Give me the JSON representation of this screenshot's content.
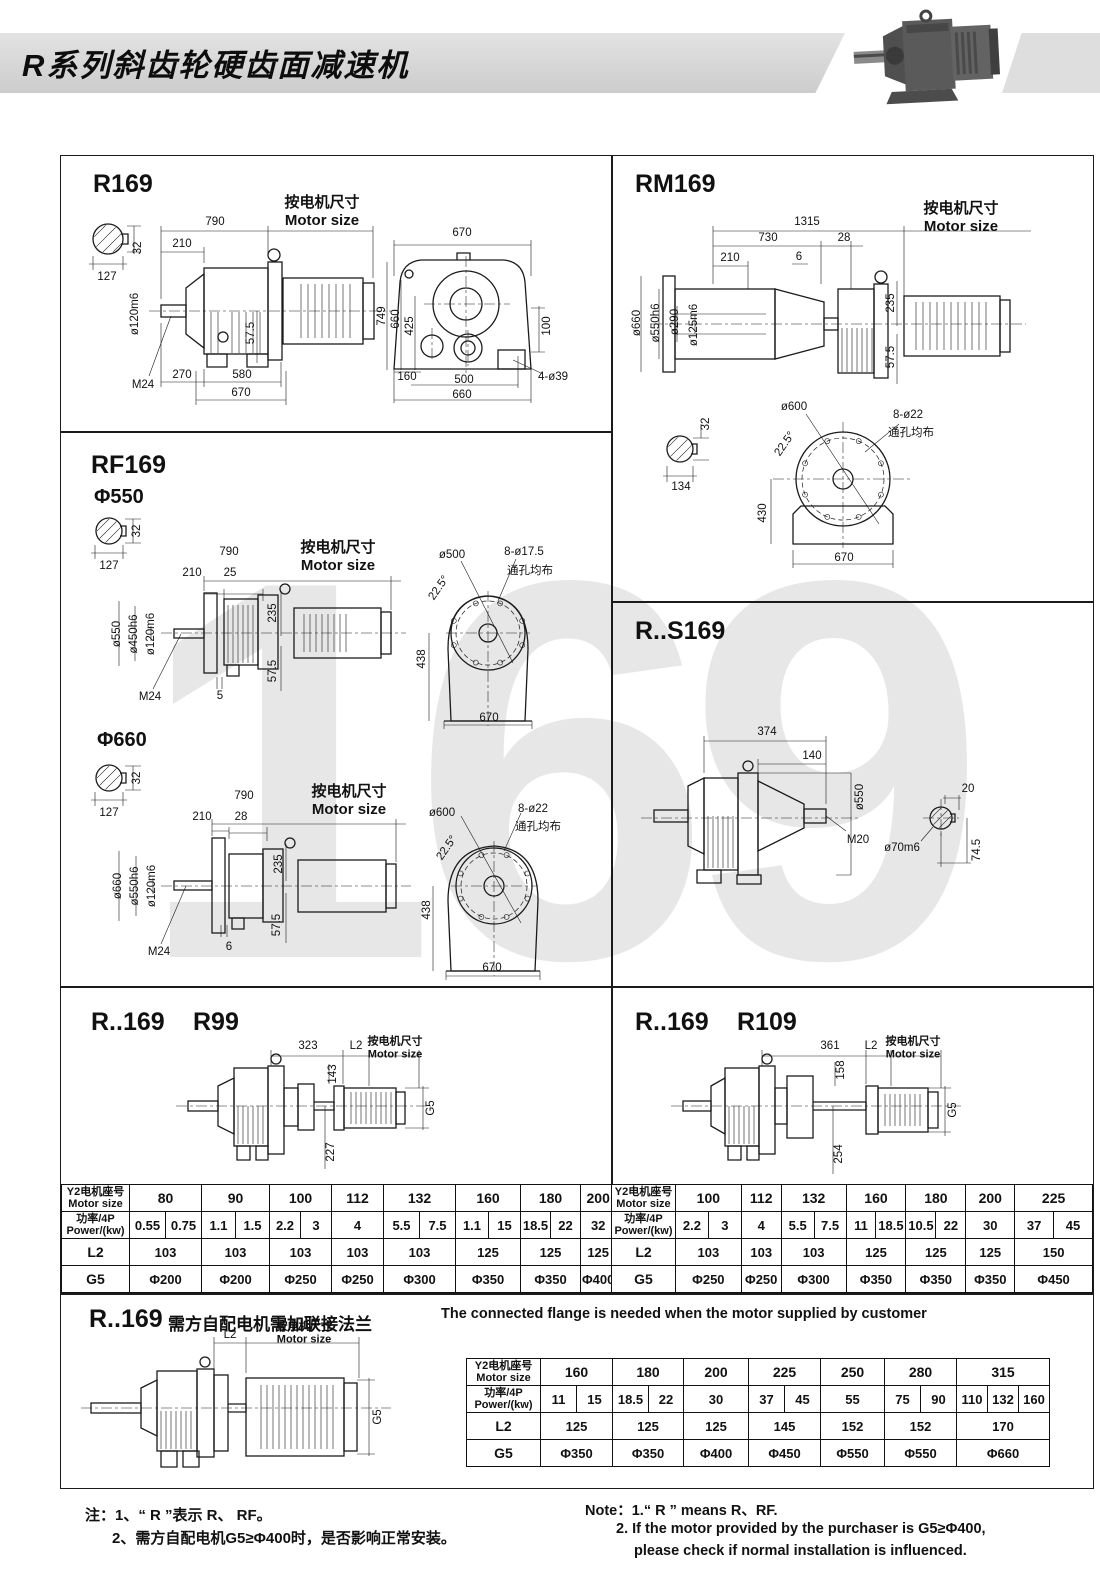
{
  "header": {
    "title": "R系列斜齿轮硬齿面减速机"
  },
  "watermark": "169",
  "common": {
    "motor_size": "按电机尺寸\nMotor size",
    "through_holes": "通孔均布"
  },
  "p": {
    "r169": {
      "title": "R169",
      "s127": "127",
      "s32": "32",
      "d790": "790",
      "d210": "210",
      "dia120": "ø120m6",
      "m24": "M24",
      "d575": "57.5",
      "d270": "270",
      "d580": "580",
      "d670": "670",
      "f670": "670",
      "f749": "749",
      "f660": "660",
      "f425": "425",
      "f100": "100",
      "f160": "160",
      "f500": "500",
      "f660b": "660",
      "holes": "4-ø39"
    },
    "rm169": {
      "title": "RM169",
      "d1315": "1315",
      "d730": "730",
      "d28": "28",
      "d210": "210",
      "d6": "6",
      "dia660": "ø660",
      "dia550": "ø550h6",
      "dia290": "ø290",
      "dia125": "ø125m6",
      "d235": "235",
      "d575": "57.5",
      "s32": "32",
      "s134": "134",
      "dia600": "ø600",
      "ang": "22.5°",
      "holes": "8-ø22",
      "d430": "430",
      "d670": "670"
    },
    "rf550": {
      "title": "RF169",
      "sub": "Φ550",
      "s127": "127",
      "s32": "32",
      "d790": "790",
      "d210": "210",
      "d25": "25",
      "dia550": "ø550",
      "dia450": "ø450h6",
      "dia120": "ø120m6",
      "m24": "M24",
      "d5": "5",
      "d235": "235",
      "d575": "57.5",
      "f500": "ø500",
      "ang": "22.5°",
      "holes": "8-ø17.5",
      "f438": "438",
      "f670": "670"
    },
    "rf660": {
      "sub": "Φ660",
      "s127": "127",
      "s32": "32",
      "d790": "790",
      "d210": "210",
      "d28": "28",
      "dia660": "ø660",
      "dia550": "ø550h6",
      "dia120": "ø120m6",
      "m24": "M24",
      "d6": "6",
      "d235": "235",
      "d575": "57.5",
      "f600": "ø600",
      "ang": "22.5°",
      "holes": "8-ø22",
      "f438": "438",
      "f670": "670"
    },
    "rs169": {
      "title": "R..S169",
      "d374": "374",
      "d140": "140",
      "dia550": "ø550",
      "m20": "M20",
      "d20": "20",
      "dia70": "ø70m6",
      "d745": "74.5"
    },
    "r99": {
      "t1": "R..169",
      "t2": "R99",
      "d323": "323",
      "l2": "L2",
      "d143": "143",
      "d227": "227",
      "g5": "G5"
    },
    "r109": {
      "t1": "R..169",
      "t2": "R109",
      "d361": "361",
      "l2": "L2",
      "d158": "158",
      "d254": "254",
      "g5": "G5"
    },
    "flange": {
      "title": "R..169",
      "sub_cn": "需方自配电机需加联接法兰",
      "sub_en": "The connected flange is needed when the motor supplied by customer",
      "l2": "L2",
      "g5": "G5"
    }
  },
  "tables": {
    "left": {
      "rows": [
        [
          {
            "t": "Y2电机座号\nMotor size",
            "h": 1
          },
          {
            "t": "80",
            "s": 2
          },
          {
            "t": "90",
            "s": 2
          },
          {
            "t": "100",
            "s": 2
          },
          {
            "t": "112"
          },
          {
            "t": "132",
            "s": 2
          },
          {
            "t": "160",
            "s": 2
          },
          {
            "t": "180",
            "s": 2
          },
          {
            "t": "200"
          }
        ],
        [
          {
            "t": "功率/4P\nPower/(kw)",
            "h": 1
          },
          {
            "t": "0.55"
          },
          {
            "t": "0.75"
          },
          {
            "t": "1.1"
          },
          {
            "t": "1.5"
          },
          {
            "t": "2.2"
          },
          {
            "t": "3"
          },
          {
            "t": "4"
          },
          {
            "t": "5.5"
          },
          {
            "t": "7.5"
          },
          {
            "t": "1.1"
          },
          {
            "t": "15"
          },
          {
            "t": "18.5"
          },
          {
            "t": "22"
          },
          {
            "t": "32"
          }
        ],
        [
          {
            "t": "L2",
            "h": 2
          },
          {
            "t": "103",
            "s": 2
          },
          {
            "t": "103",
            "s": 2
          },
          {
            "t": "103",
            "s": 2
          },
          {
            "t": "103"
          },
          {
            "t": "103",
            "s": 2
          },
          {
            "t": "125",
            "s": 2
          },
          {
            "t": "125",
            "s": 2
          },
          {
            "t": "125"
          }
        ],
        [
          {
            "t": "G5",
            "h": 2
          },
          {
            "t": "Φ200",
            "s": 2
          },
          {
            "t": "Φ200",
            "s": 2
          },
          {
            "t": "Φ250",
            "s": 2
          },
          {
            "t": "Φ250"
          },
          {
            "t": "Φ300",
            "s": 2
          },
          {
            "t": "Φ350",
            "s": 2
          },
          {
            "t": "Φ350",
            "s": 2
          },
          {
            "t": "Φ400"
          }
        ]
      ]
    },
    "right": {
      "rows": [
        [
          {
            "t": "Y2电机座号\nMotor size",
            "h": 1
          },
          {
            "t": "100",
            "s": 2
          },
          {
            "t": "112"
          },
          {
            "t": "132",
            "s": 2
          },
          {
            "t": "160",
            "s": 2
          },
          {
            "t": "180",
            "s": 2
          },
          {
            "t": "200"
          },
          {
            "t": "225",
            "s": 2
          }
        ],
        [
          {
            "t": "功率/4P\nPower/(kw)",
            "h": 1
          },
          {
            "t": "2.2"
          },
          {
            "t": "3"
          },
          {
            "t": "4"
          },
          {
            "t": "5.5"
          },
          {
            "t": "7.5"
          },
          {
            "t": "11"
          },
          {
            "t": "18.5"
          },
          {
            "t": "10.5"
          },
          {
            "t": "22"
          },
          {
            "t": "30"
          },
          {
            "t": "37"
          },
          {
            "t": "45"
          }
        ],
        [
          {
            "t": "L2",
            "h": 2
          },
          {
            "t": "103",
            "s": 2
          },
          {
            "t": "103"
          },
          {
            "t": "103",
            "s": 2
          },
          {
            "t": "125",
            "s": 2
          },
          {
            "t": "125",
            "s": 2
          },
          {
            "t": "125"
          },
          {
            "t": "150",
            "s": 2
          }
        ],
        [
          {
            "t": "G5",
            "h": 2
          },
          {
            "t": "Φ250",
            "s": 2
          },
          {
            "t": "Φ250"
          },
          {
            "t": "Φ300",
            "s": 2
          },
          {
            "t": "Φ350",
            "s": 2
          },
          {
            "t": "Φ350",
            "s": 2
          },
          {
            "t": "Φ350"
          },
          {
            "t": "Φ450",
            "s": 2
          }
        ]
      ]
    },
    "bottom": {
      "rows": [
        [
          {
            "t": "Y2电机座号\nMotor size",
            "h": 1
          },
          {
            "t": "160",
            "s": 2
          },
          {
            "t": "180",
            "s": 2
          },
          {
            "t": "200"
          },
          {
            "t": "225",
            "s": 2
          },
          {
            "t": "250"
          },
          {
            "t": "280",
            "s": 2
          },
          {
            "t": "315",
            "s": 3
          }
        ],
        [
          {
            "t": "功率/4P\nPower/(kw)",
            "h": 1
          },
          {
            "t": "11"
          },
          {
            "t": "15"
          },
          {
            "t": "18.5"
          },
          {
            "t": "22"
          },
          {
            "t": "30"
          },
          {
            "t": "37"
          },
          {
            "t": "45"
          },
          {
            "t": "55"
          },
          {
            "t": "75"
          },
          {
            "t": "90"
          },
          {
            "t": "110"
          },
          {
            "t": "132"
          },
          {
            "t": "160"
          }
        ],
        [
          {
            "t": "L2",
            "h": 2
          },
          {
            "t": "125",
            "s": 2
          },
          {
            "t": "125",
            "s": 2
          },
          {
            "t": "125"
          },
          {
            "t": "145",
            "s": 2
          },
          {
            "t": "152"
          },
          {
            "t": "152",
            "s": 2
          },
          {
            "t": "170",
            "s": 3
          }
        ],
        [
          {
            "t": "G5",
            "h": 2
          },
          {
            "t": "Φ350",
            "s": 2
          },
          {
            "t": "Φ350",
            "s": 2
          },
          {
            "t": "Φ400"
          },
          {
            "t": "Φ450",
            "s": 2
          },
          {
            "t": "Φ550"
          },
          {
            "t": "Φ550",
            "s": 2
          },
          {
            "t": "Φ660",
            "s": 3
          }
        ]
      ]
    }
  },
  "notes": {
    "cn1": "注：1、“ R ”表示 R、 RF。",
    "cn2": "2、需方自配电机G5≥Φ400时，是否影响正常安装。",
    "en1": "Note：1.“ R ” means R、RF.",
    "en2": "2. If the motor provided by the purchaser is G5≥Φ400,",
    "en3": "please check if normal installation is influenced."
  }
}
